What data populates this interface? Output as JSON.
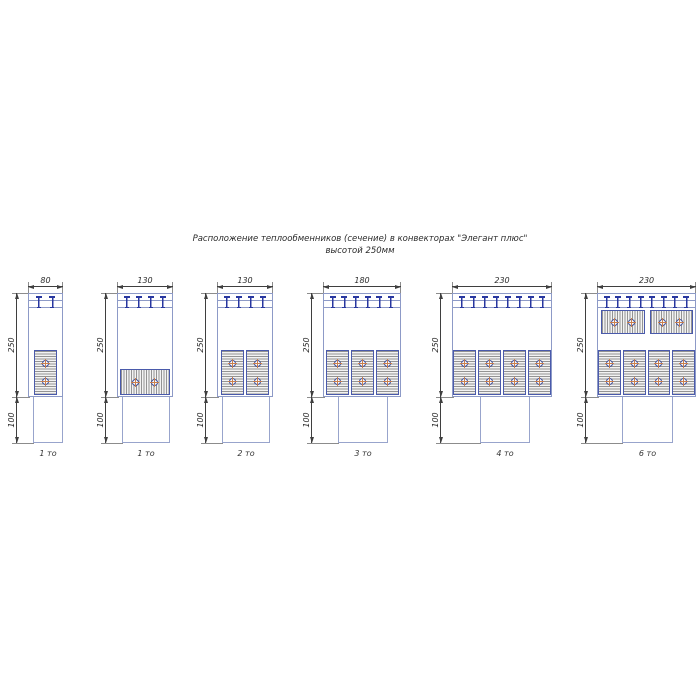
{
  "title": {
    "line1": "Расположение теплообменников (сечение) в конвекторах \"Элегант плюс\"",
    "line2": "высотой 250мм"
  },
  "diagrams": [
    {
      "caption": "1 то",
      "width_mm": "80",
      "height_mm": "250",
      "duct_mm": "100",
      "slats": 2,
      "exchangers": {
        "vertical": 1,
        "horizontal_bottom": 0,
        "horizontal_top": 0
      },
      "layout": {
        "x": 28,
        "body_w": 35,
        "duct_offset": 5,
        "duct_w": 30
      }
    },
    {
      "caption": "1 то",
      "width_mm": "130",
      "height_mm": "250",
      "duct_mm": "100",
      "slats": 4,
      "exchangers": {
        "vertical": 0,
        "horizontal_bottom": 1,
        "horizontal_top": 0
      },
      "layout": {
        "x": 117,
        "body_w": 56,
        "duct_offset": 5,
        "duct_w": 48
      }
    },
    {
      "caption": "2 то",
      "width_mm": "130",
      "height_mm": "250",
      "duct_mm": "100",
      "slats": 4,
      "exchangers": {
        "vertical": 2,
        "horizontal_bottom": 0,
        "horizontal_top": 0
      },
      "layout": {
        "x": 217,
        "body_w": 56,
        "duct_offset": 5,
        "duct_w": 48
      }
    },
    {
      "caption": "3 то",
      "width_mm": "180",
      "height_mm": "250",
      "duct_mm": "100",
      "slats": 6,
      "exchangers": {
        "vertical": 3,
        "horizontal_bottom": 0,
        "horizontal_top": 0
      },
      "layout": {
        "x": 323,
        "body_w": 78,
        "duct_offset": 15,
        "duct_w": 50
      }
    },
    {
      "caption": "4 то",
      "width_mm": "230",
      "height_mm": "250",
      "duct_mm": "100",
      "slats": 8,
      "exchangers": {
        "vertical": 4,
        "horizontal_bottom": 0,
        "horizontal_top": 0
      },
      "layout": {
        "x": 452,
        "body_w": 100,
        "duct_offset": 28,
        "duct_w": 50
      }
    },
    {
      "caption": "6 то",
      "width_mm": "230",
      "height_mm": "250",
      "duct_mm": "100",
      "slats": 8,
      "exchangers": {
        "vertical": 4,
        "horizontal_bottom": 0,
        "horizontal_top": 2
      },
      "layout": {
        "x": 597,
        "body_w": 99,
        "duct_offset": 25,
        "duct_w": 51
      }
    }
  ],
  "colors": {
    "casing_line": "#8d9ac7",
    "slat_blue": "#2837a0",
    "exchanger_border": "#4a5aab",
    "tube_ring": "#3a4a96",
    "tube_cross": "#c9804e",
    "dimension_line": "#3f3f3f",
    "extension_line": "#8c8c8c",
    "text": "#2b2b2b"
  }
}
